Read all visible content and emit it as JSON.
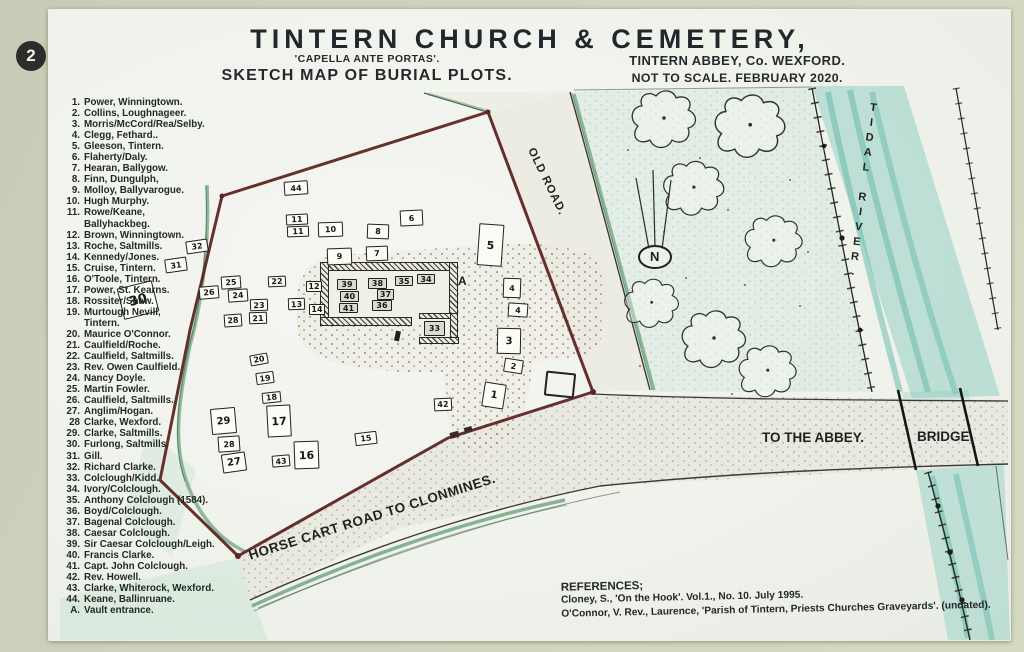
{
  "badge": "2",
  "header": {
    "title": "TINTERN CHURCH & CEMETERY,",
    "subtitle": "'CAPELLA ANTE PORTAS'.",
    "sketch_label": "SKETCH MAP OF BURIAL PLOTS.",
    "location": "TINTERN ABBEY, Co. WEXFORD.",
    "scale_note": "NOT TO SCALE. FEBRUARY 2020."
  },
  "legend": {
    "items": [
      {
        "n": "1.",
        "t": "Power, Winningtown."
      },
      {
        "n": "2.",
        "t": "Collins, Loughnageer."
      },
      {
        "n": "3.",
        "t": "Morris/McCord/Rea/Selby."
      },
      {
        "n": "4.",
        "t": "Clegg, Fethard.."
      },
      {
        "n": "5.",
        "t": "Gleeson, Tintern."
      },
      {
        "n": "6.",
        "t": "Flaherty/Daly."
      },
      {
        "n": "7.",
        "t": "Hearan, Ballygow."
      },
      {
        "n": "8.",
        "t": "Finn, Dungulph,"
      },
      {
        "n": "9.",
        "t": "Molloy, Ballyvarogue."
      },
      {
        "n": "10.",
        "t": "Hugh Murphy."
      },
      {
        "n": "11.",
        "t": "Rowe/Keane,",
        "t2": "Ballyhackbeg."
      },
      {
        "n": "12.",
        "t": "Brown, Winningtown."
      },
      {
        "n": "13.",
        "t": "Roche, Saltmills."
      },
      {
        "n": "14.",
        "t": "Kennedy/Jones."
      },
      {
        "n": "15.",
        "t": "Cruise, Tintern."
      },
      {
        "n": "16.",
        "t": "O'Toole, Tintern."
      },
      {
        "n": "17.",
        "t": "Power, St. Kearns."
      },
      {
        "n": "18.",
        "t": "Rossiter/Shaw."
      },
      {
        "n": "19.",
        "t": "Murtough Nevill,",
        "t2": "Tintern."
      },
      {
        "n": "20.",
        "t": "Maurice O'Connor."
      },
      {
        "n": "21.",
        "t": "Caulfield/Roche."
      },
      {
        "n": "22.",
        "t": "Caulfield, Saltmills."
      },
      {
        "n": "23.",
        "t": "Rev. Owen Caulfield."
      },
      {
        "n": "24.",
        "t": "Nancy Doyle."
      },
      {
        "n": "25.",
        "t": "Martin Fowler."
      },
      {
        "n": "26.",
        "t": "Caulfield, Saltmills."
      },
      {
        "n": "27.",
        "t": "Anglim/Hogan."
      },
      {
        "n": "28",
        "t": "Clarke, Wexford."
      },
      {
        "n": "29.",
        "t": "Clarke, Saltmills."
      },
      {
        "n": "30.",
        "t": "Furlong, Saltmills."
      },
      {
        "n": "31.",
        "t": "Gill."
      },
      {
        "n": "32.",
        "t": "Richard Clarke."
      },
      {
        "n": "33.",
        "t": "Colclough/Kidd."
      },
      {
        "n": "34.",
        "t": "Ivory/Colclough."
      },
      {
        "n": "35.",
        "t": "Anthony Colclough (1584)."
      },
      {
        "n": "36.",
        "t": "Boyd/Colclough."
      },
      {
        "n": "37.",
        "t": "Bagenal Colclough."
      },
      {
        "n": "38.",
        "t": "Caesar Colclough."
      },
      {
        "n": "39.",
        "t": "Sir Caesar Colclough/Leigh."
      },
      {
        "n": "40.",
        "t": "Francis Clarke."
      },
      {
        "n": "41.",
        "t": "Capt. John Colclough."
      },
      {
        "n": "42.",
        "t": "Rev. Howell."
      },
      {
        "n": "43.",
        "t": "Clarke, Whiterock, Wexford."
      },
      {
        "n": "44.",
        "t": "Keane, Ballinruane."
      },
      {
        "n": "A.",
        "t": "Vault entrance."
      }
    ]
  },
  "map": {
    "labels": {
      "old_road": "OLD ROAD.",
      "tidal_river": "TIDAL RIVER.",
      "to_the_abbey": "TO THE ABBEY.",
      "bridge": "BRIDGE.",
      "horse_cart_road": "HORSE CART ROAD TO CLONMINES.",
      "vault": "A",
      "north": "N"
    },
    "plots": [
      {
        "n": "44",
        "x": 284,
        "y": 181,
        "w": 24,
        "h": 14,
        "r": -4
      },
      {
        "n": "11",
        "x": 286,
        "y": 214,
        "w": 22,
        "h": 11,
        "r": -3
      },
      {
        "n": "11",
        "x": 287,
        "y": 226,
        "w": 22,
        "h": 11,
        "r": -2
      },
      {
        "n": "10",
        "x": 318,
        "y": 222,
        "w": 25,
        "h": 15,
        "r": -2
      },
      {
        "n": "8",
        "x": 367,
        "y": 224,
        "w": 22,
        "h": 15,
        "r": 2
      },
      {
        "n": "6",
        "x": 400,
        "y": 210,
        "w": 23,
        "h": 16,
        "r": -3
      },
      {
        "n": "9",
        "x": 327,
        "y": 248,
        "w": 25,
        "h": 17,
        "r": -2
      },
      {
        "n": "7",
        "x": 366,
        "y": 246,
        "w": 22,
        "h": 15,
        "r": -2
      },
      {
        "n": "5",
        "x": 478,
        "y": 224,
        "w": 25,
        "h": 42,
        "r": 4,
        "fs": 11
      },
      {
        "n": "4",
        "x": 503,
        "y": 278,
        "w": 18,
        "h": 20,
        "r": 2
      },
      {
        "n": "4",
        "x": 508,
        "y": 303,
        "w": 20,
        "h": 14,
        "r": 4
      },
      {
        "n": "3",
        "x": 497,
        "y": 328,
        "w": 24,
        "h": 26,
        "r": 1,
        "fs": 10
      },
      {
        "n": "2",
        "x": 504,
        "y": 359,
        "w": 19,
        "h": 14,
        "r": 9
      },
      {
        "n": "1",
        "x": 483,
        "y": 383,
        "w": 22,
        "h": 25,
        "r": 9,
        "fs": 10
      },
      {
        "n": "42",
        "x": 434,
        "y": 398,
        "w": 18,
        "h": 13,
        "r": -3
      },
      {
        "n": "32",
        "x": 186,
        "y": 240,
        "w": 22,
        "h": 13,
        "r": -8
      },
      {
        "n": "31",
        "x": 165,
        "y": 258,
        "w": 22,
        "h": 14,
        "r": -8
      },
      {
        "n": "30",
        "x": 120,
        "y": 284,
        "w": 36,
        "h": 32,
        "r": -14,
        "fs": 13
      },
      {
        "n": "26",
        "x": 199,
        "y": 286,
        "w": 20,
        "h": 13,
        "r": -5
      },
      {
        "n": "25",
        "x": 221,
        "y": 276,
        "w": 20,
        "h": 13,
        "r": -4
      },
      {
        "n": "24",
        "x": 228,
        "y": 289,
        "w": 20,
        "h": 13,
        "r": -4
      },
      {
        "n": "22",
        "x": 268,
        "y": 276,
        "w": 18,
        "h": 11,
        "r": -3
      },
      {
        "n": "23",
        "x": 250,
        "y": 299,
        "w": 18,
        "h": 12,
        "r": -2
      },
      {
        "n": "21",
        "x": 249,
        "y": 312,
        "w": 18,
        "h": 12,
        "r": -2
      },
      {
        "n": "28",
        "x": 224,
        "y": 314,
        "w": 18,
        "h": 13,
        "r": -4
      },
      {
        "n": "12",
        "x": 306,
        "y": 281,
        "w": 16,
        "h": 11,
        "r": 0
      },
      {
        "n": "13",
        "x": 288,
        "y": 298,
        "w": 17,
        "h": 12,
        "r": -2
      },
      {
        "n": "14",
        "x": 309,
        "y": 304,
        "w": 16,
        "h": 11,
        "r": 0
      },
      {
        "n": "20",
        "x": 250,
        "y": 354,
        "w": 18,
        "h": 11,
        "r": -10
      },
      {
        "n": "19",
        "x": 256,
        "y": 372,
        "w": 18,
        "h": 12,
        "r": -8
      },
      {
        "n": "18",
        "x": 262,
        "y": 392,
        "w": 19,
        "h": 11,
        "r": -6
      },
      {
        "n": "17",
        "x": 267,
        "y": 405,
        "w": 24,
        "h": 32,
        "r": -3,
        "fs": 11
      },
      {
        "n": "29",
        "x": 211,
        "y": 408,
        "w": 25,
        "h": 26,
        "r": -5,
        "fs": 10
      },
      {
        "n": "28",
        "x": 218,
        "y": 436,
        "w": 22,
        "h": 16,
        "r": -4
      },
      {
        "n": "27",
        "x": 222,
        "y": 453,
        "w": 24,
        "h": 19,
        "r": -8,
        "fs": 10
      },
      {
        "n": "43",
        "x": 272,
        "y": 455,
        "w": 18,
        "h": 12,
        "r": -5
      },
      {
        "n": "16",
        "x": 294,
        "y": 441,
        "w": 25,
        "h": 28,
        "r": -2,
        "fs": 11
      },
      {
        "n": "15",
        "x": 355,
        "y": 432,
        "w": 22,
        "h": 13,
        "r": -7
      },
      {
        "n": "33",
        "x": 424,
        "y": 321,
        "w": 21,
        "h": 15,
        "r": 0,
        "in": true
      },
      {
        "n": "39",
        "x": 337,
        "y": 279,
        "w": 20,
        "h": 11,
        "r": 0,
        "in": true
      },
      {
        "n": "38",
        "x": 368,
        "y": 278,
        "w": 19,
        "h": 11,
        "r": 0,
        "in": true
      },
      {
        "n": "35",
        "x": 395,
        "y": 276,
        "w": 18,
        "h": 10,
        "r": 0,
        "in": true
      },
      {
        "n": "34",
        "x": 417,
        "y": 274,
        "w": 18,
        "h": 10,
        "r": 0,
        "in": true
      },
      {
        "n": "40",
        "x": 340,
        "y": 291,
        "w": 19,
        "h": 11,
        "r": 0,
        "in": true
      },
      {
        "n": "37",
        "x": 377,
        "y": 289,
        "w": 17,
        "h": 11,
        "r": 0,
        "in": true
      },
      {
        "n": "41",
        "x": 339,
        "y": 303,
        "w": 19,
        "h": 10,
        "r": 0,
        "in": true
      },
      {
        "n": "36",
        "x": 372,
        "y": 300,
        "w": 20,
        "h": 11,
        "r": 0,
        "in": true
      }
    ]
  },
  "references": {
    "heading": "REFERENCES;",
    "lines": [
      "Cloney, S., 'On the Hook'. Vol.1., No. 10. July 1995.",
      "O'Connor, V. Rev., Laurence, 'Parish of Tintern, Priests Churches Graveyards'. (undated)."
    ]
  },
  "colors": {
    "boundary": "#5d2522",
    "river": "#93cfc3",
    "hedge": "#4f8f63",
    "ink": "#2b2b26",
    "sign_bg": "#f2f3ee",
    "frame_bg": "#ced3bd"
  }
}
